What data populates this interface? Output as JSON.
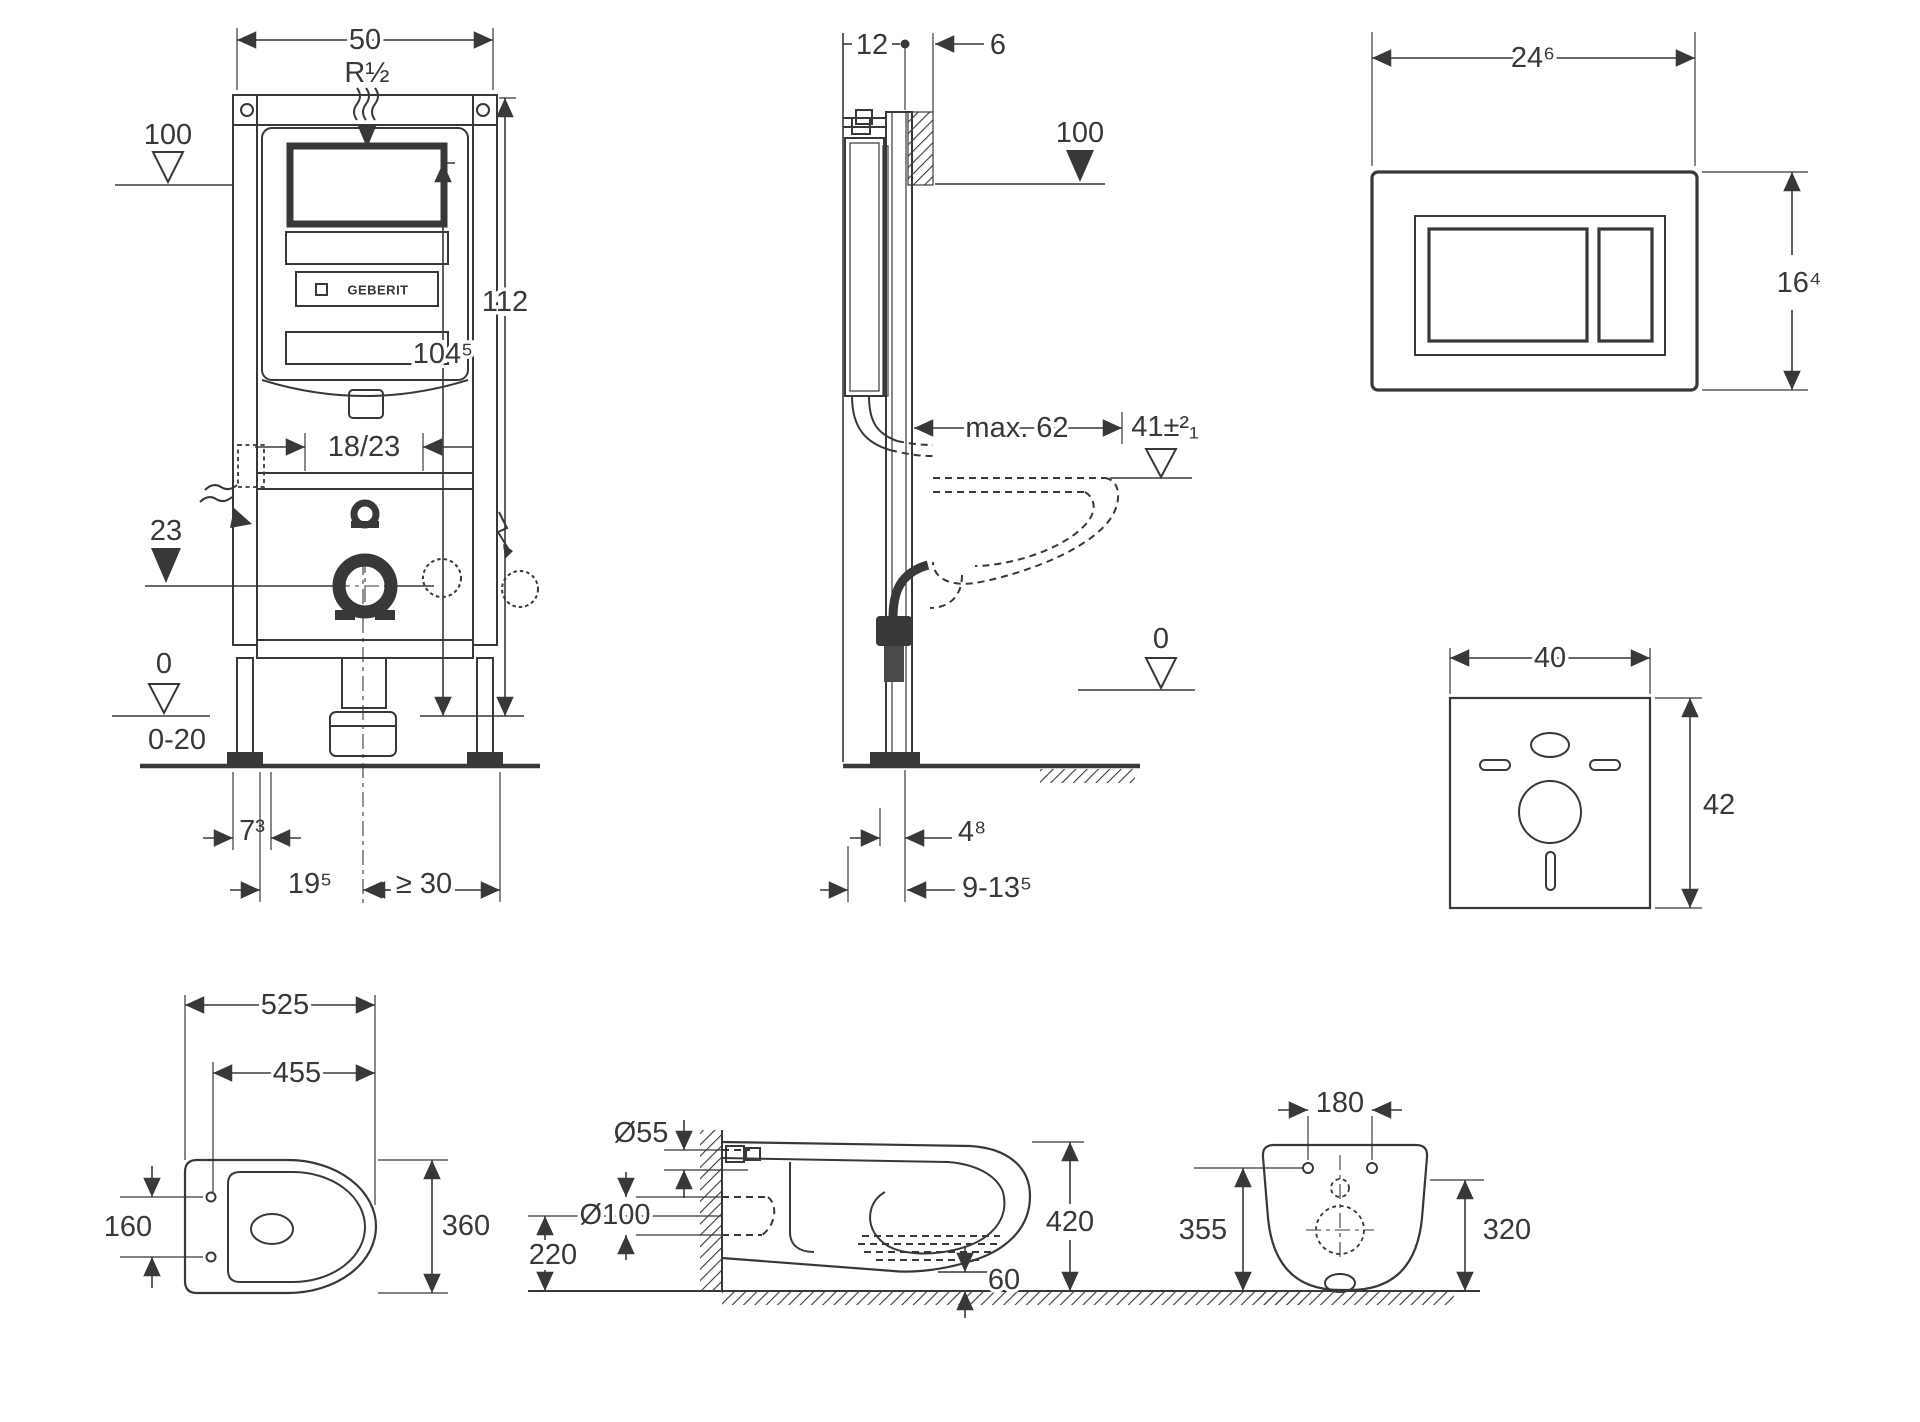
{
  "figures": {
    "frame_front": {
      "name": "concealed cistern frame - front view",
      "width_top": "50",
      "thread": "R½",
      "level_100": "100",
      "height_full": "112",
      "height_supply": "104⁵",
      "bracket_offset": "18/23",
      "outlet_level": "23",
      "zero_level": "0",
      "floor_range": "0-20",
      "foot_depth": "7³",
      "outlet_left": "19⁵",
      "outlet_right": "≥ 30",
      "brand": "GEBERIT"
    },
    "frame_side": {
      "name": "concealed cistern frame - side view",
      "depth_12": "12",
      "gap_6": "6",
      "level_100": "100",
      "max_62": "max. 62",
      "rim_41": "41±²₁",
      "zero_level": "0",
      "dim_48": "4⁸",
      "dim_9135": "9-13⁵"
    },
    "flush_plate": {
      "name": "flush actuator plate",
      "width": "24⁶",
      "height": "16⁴"
    },
    "sound_insulation": {
      "name": "sound insulation mat",
      "width": "40",
      "height": "42"
    },
    "wc_top": {
      "name": "wc pan - top view",
      "length": "525",
      "length_inner": "455",
      "hole_spacing": "160",
      "width": "360"
    },
    "wc_side": {
      "name": "wc pan - side view",
      "supply_dia": "Ø55",
      "drain_dia": "Ø100",
      "drain_height": "220",
      "rim_height": "420",
      "clearance": "60"
    },
    "wc_back": {
      "name": "wc pan - rear view",
      "hole_spacing": "180",
      "height_355": "355",
      "height_320": "320"
    }
  }
}
